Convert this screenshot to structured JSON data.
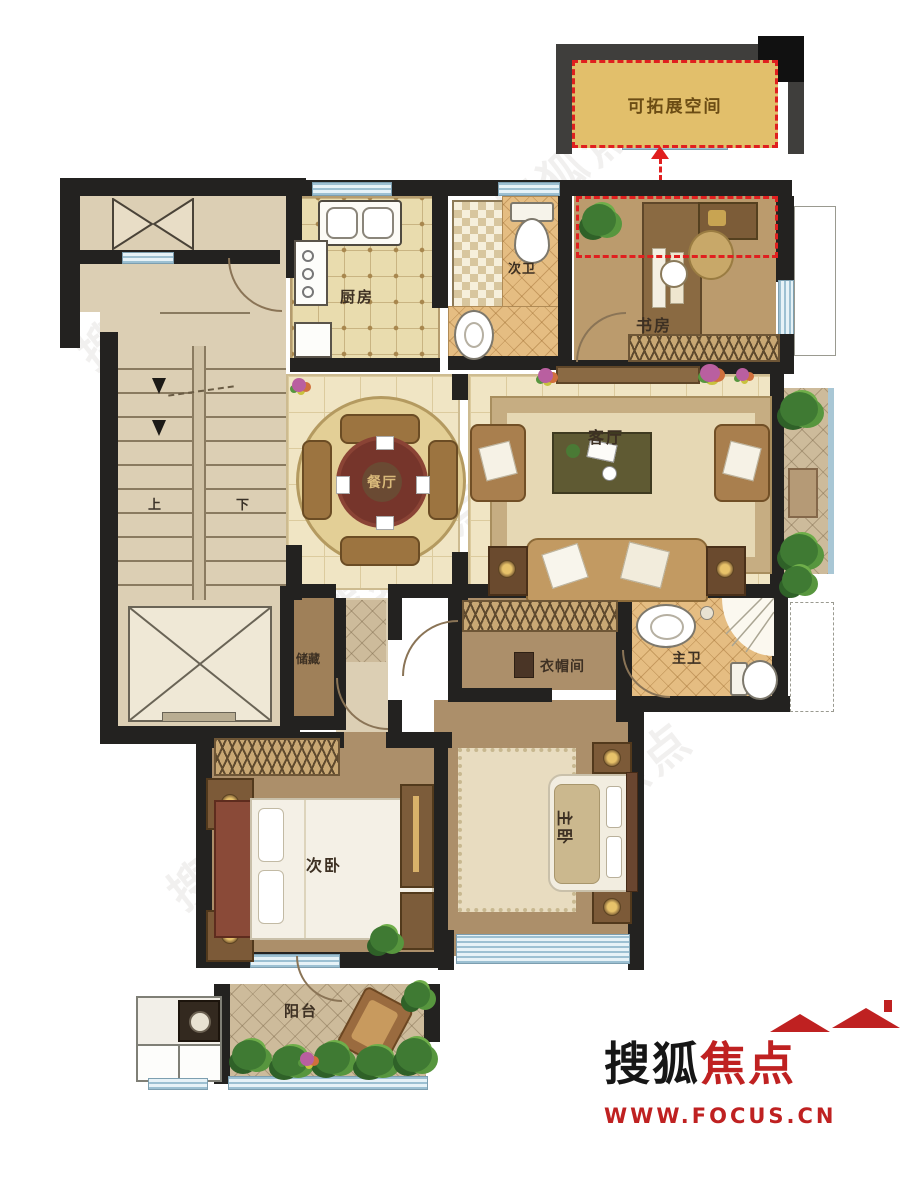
{
  "annotation": {
    "expandable_space": "可拓展空间"
  },
  "rooms": {
    "kitchen": {
      "label": "厨房"
    },
    "bath_secondary": {
      "label": "次卫"
    },
    "study": {
      "label": "书房"
    },
    "dining": {
      "label": "餐厅"
    },
    "living": {
      "label": "客厅"
    },
    "storage": {
      "label": "储藏"
    },
    "cloakroom": {
      "label": "衣帽间"
    },
    "bath_master": {
      "label": "主卫"
    },
    "bedroom_secondary": {
      "label": "次卧"
    },
    "bedroom_master": {
      "label": "主卧"
    },
    "balcony": {
      "label": "阳台"
    }
  },
  "stairs": {
    "up": "上",
    "down": "下"
  },
  "logo": {
    "brand_black": "搜狐",
    "brand_red": "焦点",
    "url": "WWW.FOCUS.CN"
  },
  "watermark": {
    "text": "搜狐焦点"
  },
  "colors": {
    "wall": "#232220",
    "accent_red": "#e01f1f",
    "expandable_fill": "#e2bf6b",
    "window_blue": "#cfe4ee",
    "logo_red": "#bf2121"
  }
}
